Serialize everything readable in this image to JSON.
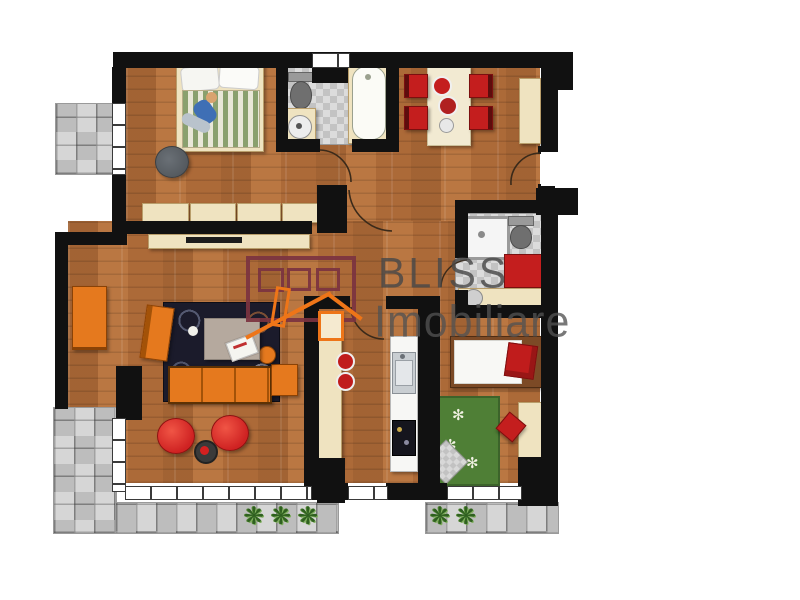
{
  "watermark": {
    "brand_line1": "BLISS",
    "brand_line2": "Imobiliare",
    "logo": "house-outline-icon",
    "text_color": "#4a4a4a",
    "logo_body_color": "#7b3340",
    "logo_accent_color": "#ee7518"
  },
  "floor_plan": {
    "type": "apartment-top-down-render",
    "colors": {
      "wall": "#111111",
      "wood_floor": "#b5713d",
      "bath_tile": "#d4d4d4",
      "terrace_paving": "#cbcbcb",
      "sofa_orange": "#e5791e",
      "accent_red": "#c41e1e",
      "furniture_cream": "#efe3c0",
      "rug_navy": "#1b1b2b",
      "rug_green": "#4f7f36"
    },
    "rooms": [
      {
        "name": "main-bedroom",
        "position": "top-left",
        "floor": "wood",
        "furniture": [
          "double-bed",
          "pillows",
          "striped-duvet",
          "person-lying",
          "round-dark-rug",
          "wardrobe-4-sections"
        ]
      },
      {
        "name": "balcony",
        "position": "left",
        "floor": "gray-tile",
        "furniture": []
      },
      {
        "name": "main-bathroom",
        "position": "top-center",
        "floor": "checkered-tile",
        "furniture": [
          "toilet",
          "pedestal-washbasin",
          "bathtub"
        ]
      },
      {
        "name": "dining-room",
        "position": "top-right",
        "floor": "wood",
        "furniture": [
          "dining-table",
          "red-chair-1",
          "red-chair-2",
          "red-chair-3",
          "red-chair-4",
          "plates",
          "sideboard"
        ]
      },
      {
        "name": "living-room",
        "position": "center-left",
        "floor": "wood",
        "furniture": [
          "tv-console",
          "two-seat-orange-sofa",
          "orange-armchair",
          "three-seat-orange-sofa",
          "orange-ottoman",
          "navy-rug",
          "coffee-table",
          "magazine",
          "orange-stool",
          "red-pouf-1",
          "red-pouf-2",
          "round-side-table"
        ]
      },
      {
        "name": "kitchen",
        "position": "center-bottom",
        "floor": "wood",
        "furniture": [
          "cream-counter",
          "red-plate-1",
          "red-plate-2",
          "white-counter",
          "sink",
          "cooktop"
        ]
      },
      {
        "name": "second-bathroom",
        "position": "right-center",
        "floor": "checkered-tile",
        "furniture": [
          "shower",
          "toilet",
          "vanity-washbasin",
          "red-mat"
        ]
      },
      {
        "name": "second-bedroom",
        "position": "right-bottom",
        "floor": "wood",
        "furniture": [
          "single-bed",
          "red-pillow",
          "desk",
          "red-chair",
          "green-flower-rug",
          "gray-mat"
        ]
      },
      {
        "name": "terrace",
        "position": "bottom-left",
        "floor": "gray-paving",
        "furniture": [
          "plant-1",
          "plant-2",
          "plant-3",
          "plant-4",
          "plant-5"
        ]
      }
    ],
    "openings": {
      "windows": 6,
      "interior_door_arcs": 5,
      "entrance_side": "right"
    }
  }
}
